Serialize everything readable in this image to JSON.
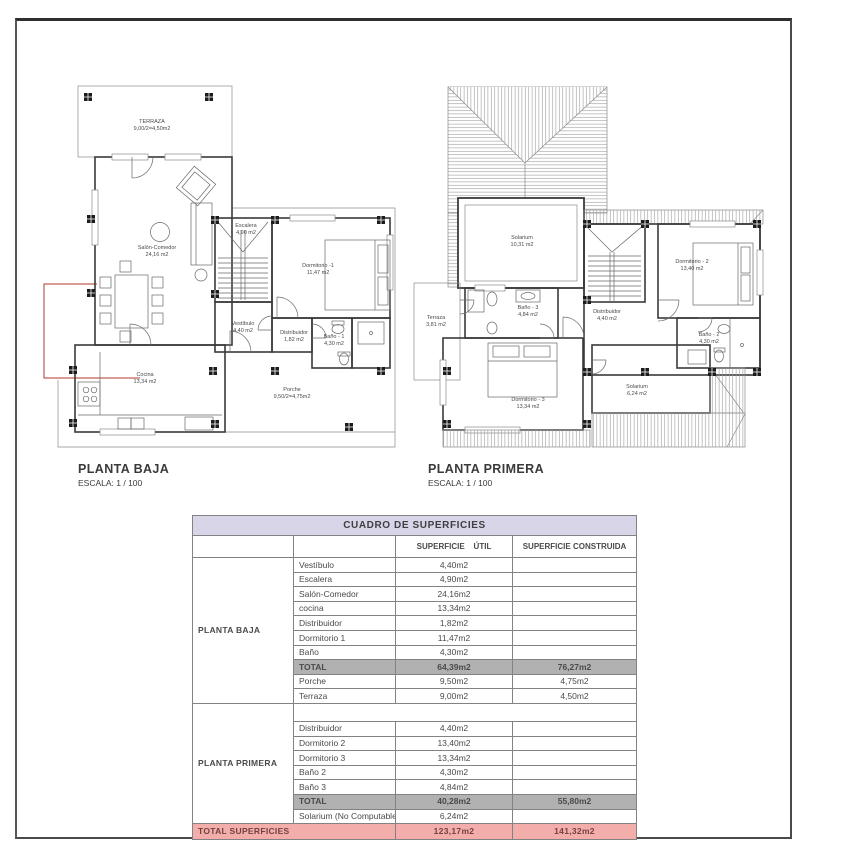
{
  "colors": {
    "table_header_bg": "#d8d5e9",
    "total_row_bg": "#b1b1b1",
    "grand_total_bg": "#f3aeac",
    "grand_total_text": "#74403e",
    "red_overlay_line": "#b03a2e"
  },
  "plans": {
    "baja": {
      "title": "PLANTA BAJA",
      "scale": "ESCALA: 1 / 100",
      "rooms": {
        "terraza": {
          "name": "TERRAZA",
          "area": "9,00/2=4,50m2"
        },
        "salon": {
          "name": "Salón-Comedor",
          "area": "24,16 m2"
        },
        "escalera": {
          "name": "Escalera",
          "area": "4,90 m2"
        },
        "dormitorio1": {
          "name": "Dormitorio -1",
          "area": "11,47 m2"
        },
        "vestibulo": {
          "name": "Vestíbulo",
          "area": "4,40 m2"
        },
        "distribuidor": {
          "name": "Distribuidor",
          "area": "1,82 m2"
        },
        "bano1": {
          "name": "Baño - 1",
          "area": "4,30 m2"
        },
        "cocina": {
          "name": "Cocina",
          "area": "13,34 m2"
        },
        "porche": {
          "name": "Porche",
          "area": "9,50/2=4,75m2"
        }
      }
    },
    "primera": {
      "title": "PLANTA PRIMERA",
      "scale": "ESCALA: 1 / 100",
      "rooms": {
        "solarium_top": {
          "name": "Solarium",
          "area": "10,31 m2"
        },
        "terraza": {
          "name": "Terraza",
          "area": "3,81 m2"
        },
        "bano3": {
          "name": "Baño - 3",
          "area": "4,84 m2"
        },
        "distribuidor": {
          "name": "Distribuidor",
          "area": "4,40 m2"
        },
        "dormitorio2": {
          "name": "Dormitorio - 2",
          "area": "13,40 m2"
        },
        "bano2": {
          "name": "Baño - 2",
          "area": "4,30 m2"
        },
        "dormitorio3": {
          "name": "Dormitorio - 3",
          "area": "13,34 m2"
        },
        "solarium_bottom": {
          "name": "Solarium",
          "area": "6,24 m2"
        }
      }
    }
  },
  "table": {
    "title": "CUADRO DE SUPERFICIES",
    "headers": {
      "util": "SUPERFICIE    ÚTIL",
      "construida": "SUPERFICIE CONSTRUIDA"
    },
    "sections": [
      {
        "group": "PLANTA BAJA",
        "rows": [
          {
            "name": "Vestíbulo",
            "util": "4,40m2",
            "cons": ""
          },
          {
            "name": "Escalera",
            "util": "4,90m2",
            "cons": ""
          },
          {
            "name": "Salón-Comedor",
            "util": "24,16m2",
            "cons": ""
          },
          {
            "name": "cocina",
            "util": "13,34m2",
            "cons": ""
          },
          {
            "name": "Distribuidor",
            "util": "1,82m2",
            "cons": ""
          },
          {
            "name": "Dormitorio 1",
            "util": "11,47m2",
            "cons": ""
          },
          {
            "name": "Baño",
            "util": "4,30m2",
            "cons": ""
          },
          {
            "name": "TOTAL",
            "util": "64,39m2",
            "cons": "76,27m2"
          },
          {
            "name": "Porche",
            "util": "9,50m2",
            "cons": "4,75m2"
          },
          {
            "name": "Terraza",
            "util": "9,00m2",
            "cons": "4,50m2"
          }
        ]
      },
      {
        "group": "PLANTA PRIMERA",
        "rows": [
          {
            "name": "Distribuidor",
            "util": "4,40m2",
            "cons": ""
          },
          {
            "name": "Dormitorio 2",
            "util": "13,40m2",
            "cons": ""
          },
          {
            "name": "Dormitorio 3",
            "util": "13,34m2",
            "cons": ""
          },
          {
            "name": "Baño 2",
            "util": "4,30m2",
            "cons": ""
          },
          {
            "name": "Baño 3",
            "util": "4,84m2",
            "cons": ""
          },
          {
            "name": "TOTAL",
            "util": "40,28m2",
            "cons": "55,80m2"
          },
          {
            "name": "Solarium (No Computable)",
            "util": "6,24m2",
            "cons": ""
          }
        ]
      }
    ],
    "grand": {
      "label": "TOTAL SUPERFICIES",
      "util": "123,17m2",
      "cons": "141,32m2"
    }
  }
}
